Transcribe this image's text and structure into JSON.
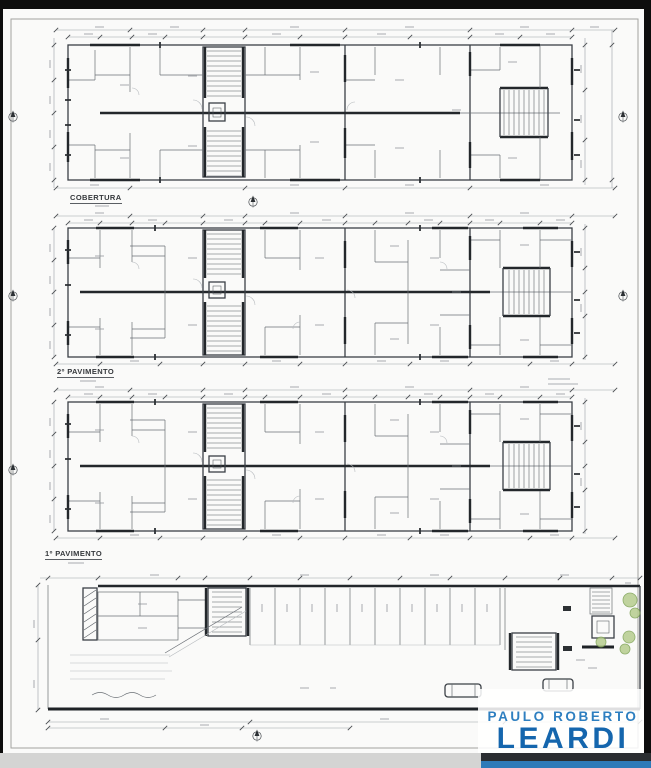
{
  "floor_labels": [
    {
      "label": "COBERTURA"
    },
    {
      "label": "2º PAVIMENTO"
    },
    {
      "label": "1º PAVIMENTO"
    }
  ],
  "logo": {
    "line1": "PAULO ROBERTO",
    "line2": "LEARDI"
  },
  "colors": {
    "logo_blue": "#2e7fc0",
    "logo_blue_dark": "#1566ad",
    "logo_bar_blue": "#2e7ab8",
    "drawing_line": "#3b4046",
    "dimension_line": "#9aa0a5",
    "tree_green": "#8fae62",
    "frame_black": "#0d0d0d",
    "bottom_strip_gray": "#d4d4d3",
    "sheet_white": "#fafaf9"
  },
  "icons": {
    "north_arrow": "compass"
  }
}
